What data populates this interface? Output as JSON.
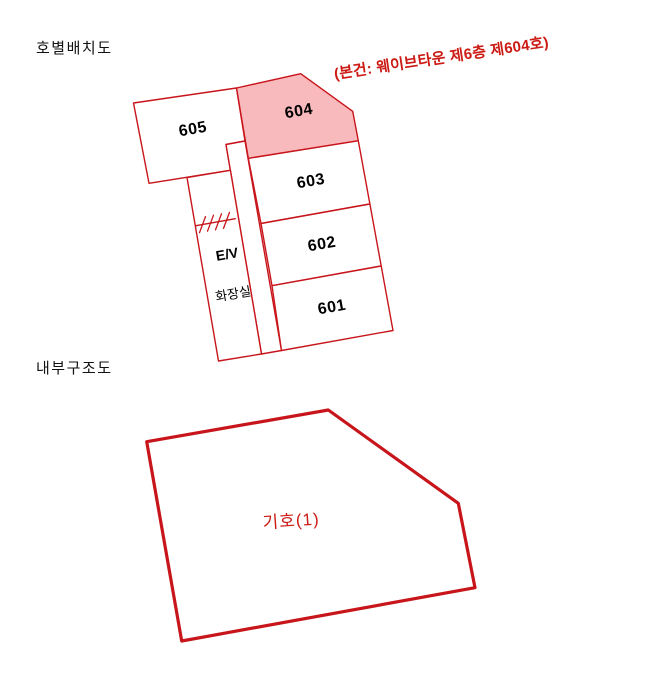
{
  "colors": {
    "line": "#C8151B",
    "highlight_fill": "#F9BABE",
    "room_fill": "#FFFFFF",
    "annotation_text": "#CC1A14",
    "title_text": "#111111",
    "label_text": "#000000"
  },
  "unit_layout": {
    "title": "호별배치도",
    "annotation": "(본건: 웨이브타운 제6층 제604호)",
    "units": [
      {
        "label": "605",
        "highlighted": false
      },
      {
        "label": "604",
        "highlighted": true
      },
      {
        "label": "603",
        "highlighted": false
      },
      {
        "label": "602",
        "highlighted": false
      },
      {
        "label": "601",
        "highlighted": false
      }
    ],
    "elevator_label": "E/V",
    "toilet_label": "화장실"
  },
  "internal_structure": {
    "title": "내부구조도",
    "parcel_label": "기호(1)"
  }
}
